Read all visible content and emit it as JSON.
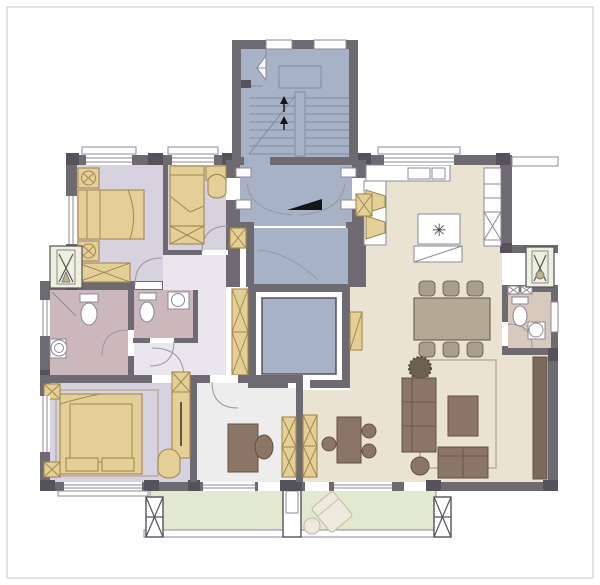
{
  "meta": {
    "title": "apartment-floor-plan",
    "width": 600,
    "height": 585
  },
  "colors": {
    "wall": "#6e6a72",
    "wallDark": "#56525b",
    "stairFloor": "#a8b2c6",
    "stairLine": "#7f8aa3",
    "lavenderFloor": "#d6d2df",
    "hallFloor": "#e9e7ed",
    "bathPink": "#ccb8bc",
    "studyFloor": "#ededee",
    "creamFloor": "#eae3d2",
    "bathBeige": "#d8c9be",
    "tan": "#e4cf97",
    "tanStroke": "#a2884e",
    "brown": "#8a7567",
    "brownDark": "#63523f",
    "chairFill": "#a89e8b",
    "tableTop": "#b3a994",
    "balcony": "#e3e8d0",
    "greenStroke": "#9aa17e",
    "acBox": "#eff1df",
    "line": "#8b8894",
    "arcColor": "#9a96a0",
    "rugStroke": "#bcae98",
    "black": "#141414",
    "frame": "#dcdcdc",
    "loungeFill": "#edeadd",
    "loungeStroke": "#c6c1ae",
    "plantFill": "#6e6050",
    "plantStroke": "#4e4438"
  },
  "symbols": {
    "server_marker": "✳"
  },
  "plan": {
    "core": [
      "stairwell",
      "shared-lobby",
      "elevator"
    ],
    "left_unit_rooms": [
      "bedroom-1",
      "bedroom-2",
      "bathroom-1",
      "bathroom-2",
      "master-bedroom",
      "study",
      "hallway"
    ],
    "right_unit_rooms": [
      "kitchen",
      "dining-room",
      "tea-area",
      "living-room",
      "bathroom-3"
    ],
    "outdoor": [
      "left-balcony",
      "right-balcony",
      "ac-platform-left",
      "ac-platform-right"
    ]
  }
}
